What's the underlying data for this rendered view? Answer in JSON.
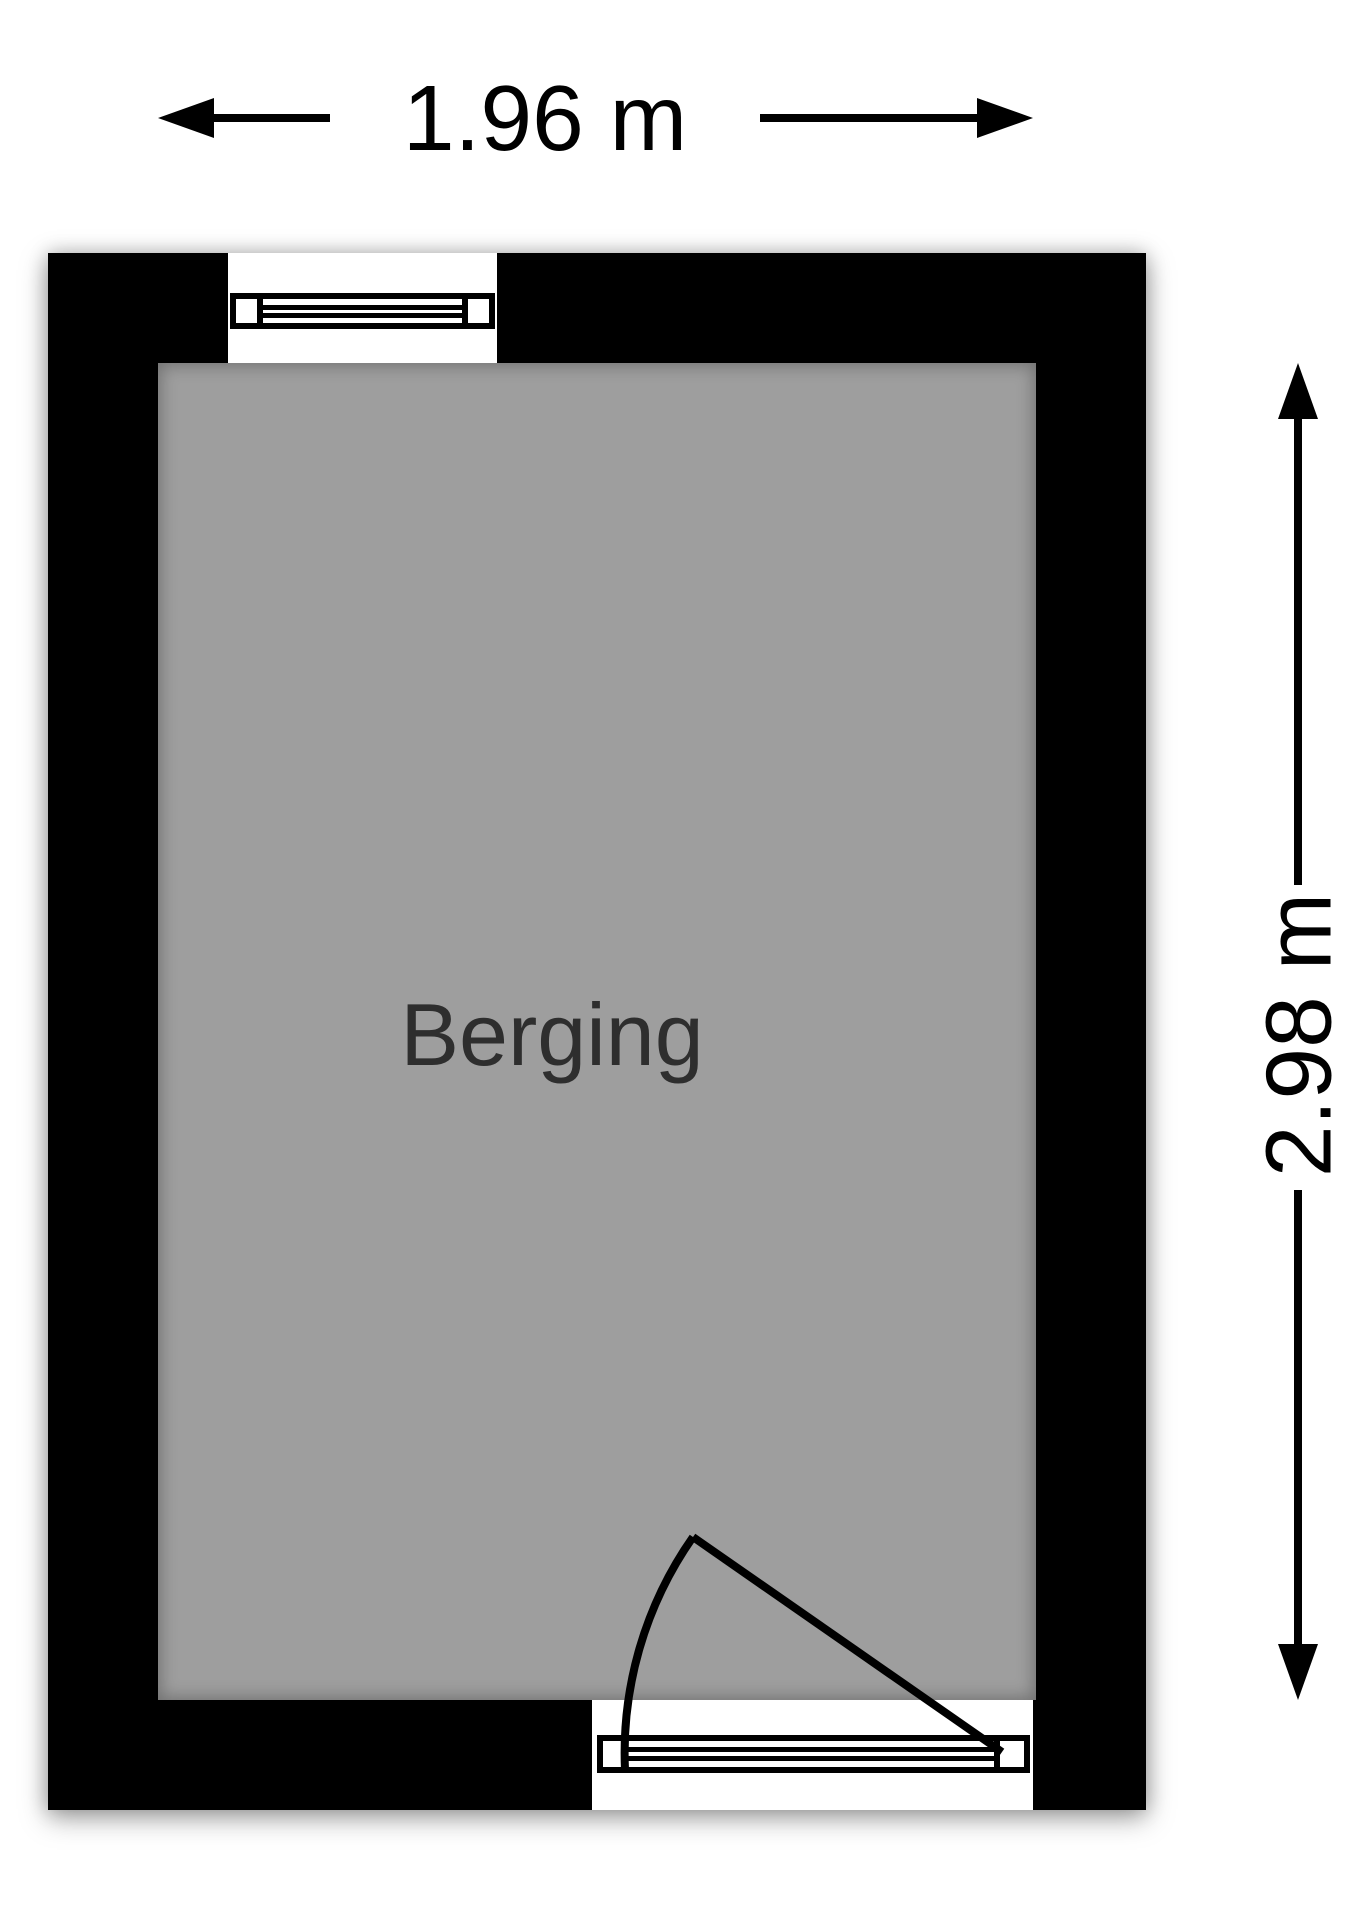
{
  "room": {
    "label": "Berging"
  },
  "dimensions": {
    "width": {
      "label": "1.96 m"
    },
    "height": {
      "label": "2.98 m"
    }
  },
  "colors": {
    "wall": "#000000",
    "floor": "#9e9e9e",
    "room_label": "#2e2e2e",
    "dimension": "#000000",
    "background": "#ffffff"
  }
}
